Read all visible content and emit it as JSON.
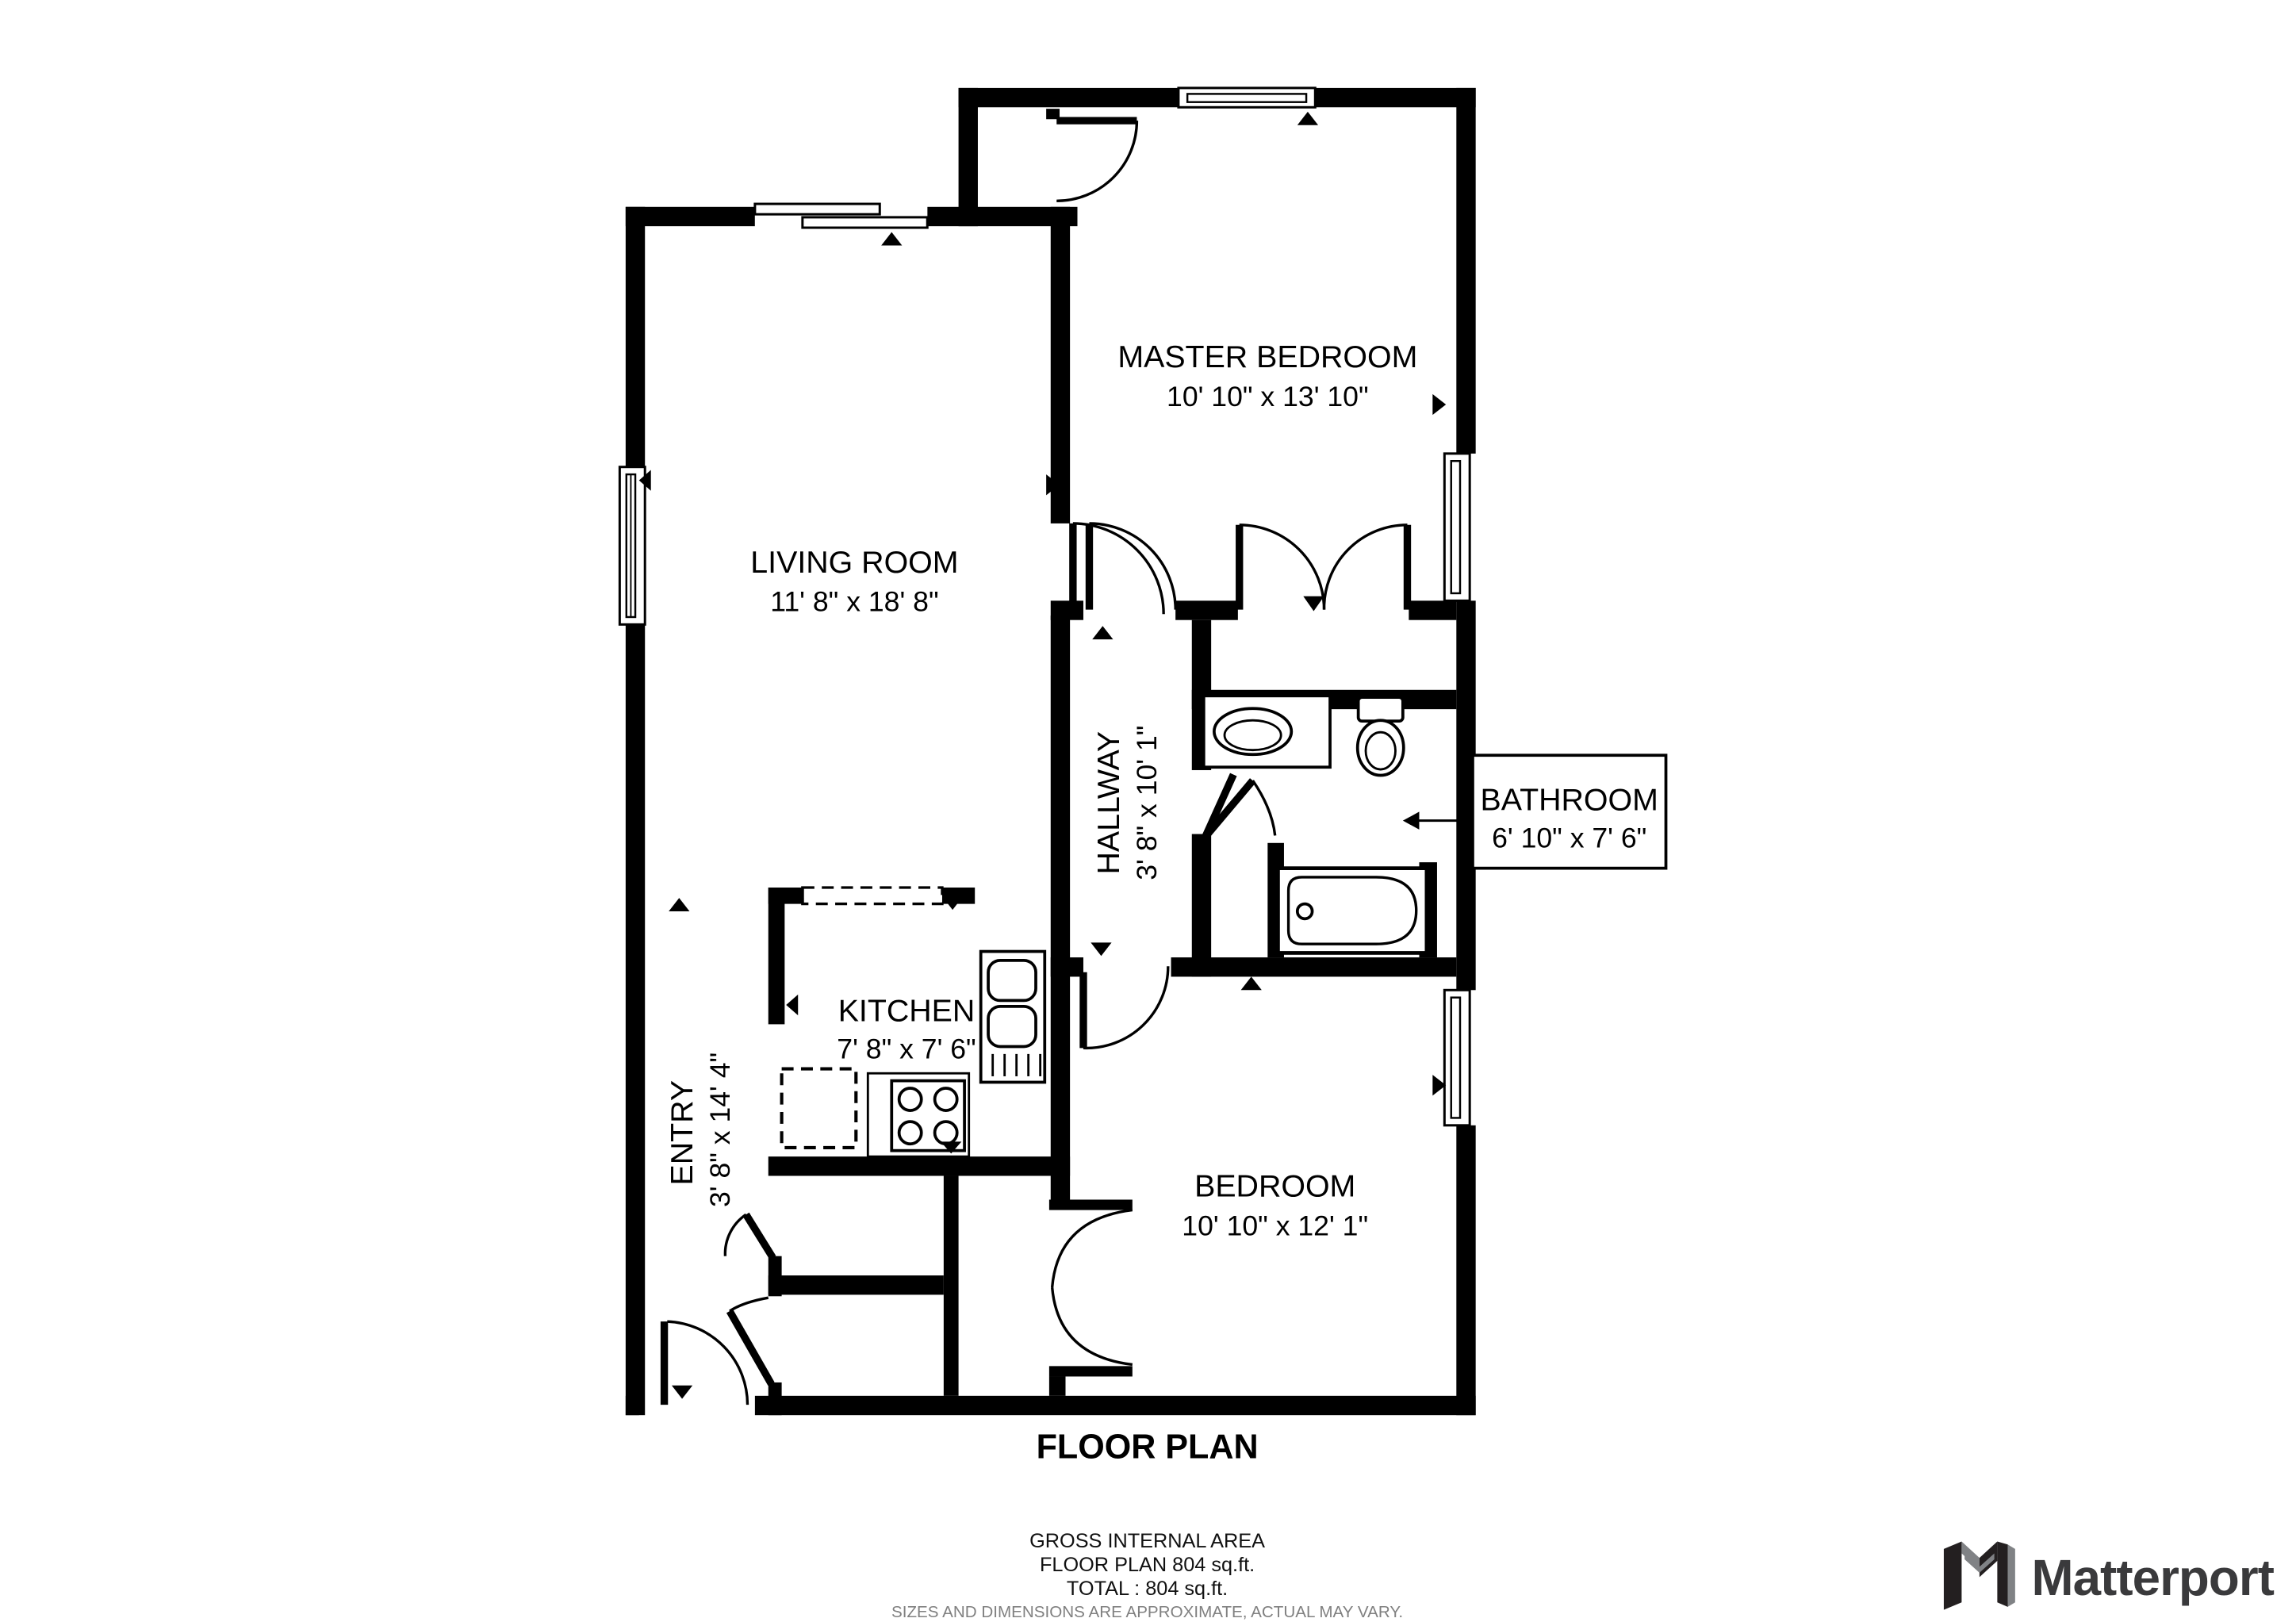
{
  "page": {
    "background": "#ffffff"
  },
  "floor_plan": {
    "title": "FLOOR PLAN",
    "rooms": {
      "master_bedroom": {
        "name": "MASTER BEDROOM",
        "dims": "10' 10\" x 13' 10\""
      },
      "living_room": {
        "name": "LIVING ROOM",
        "dims": "11' 8\" x 18' 8\""
      },
      "hallway": {
        "name": "HALLWAY",
        "dims": "3' 8\" x 10' 1\""
      },
      "bathroom": {
        "name": "BATHROOM",
        "dims": "6' 10\" x 7' 6\""
      },
      "kitchen": {
        "name": "KITCHEN",
        "dims": "7' 8\" x 7' 6\""
      },
      "entry": {
        "name": "ENTRY",
        "dims": "3' 8\" x 14' 4\""
      },
      "bedroom": {
        "name": "BEDROOM",
        "dims": "10' 10\" x 12' 1\""
      }
    },
    "area_summary": {
      "heading": "GROSS INTERNAL AREA",
      "floor_line": "FLOOR PLAN 804 sq.ft.",
      "total_line": "TOTAL :  804 sq.ft.",
      "disclaimer": "SIZES AND DIMENSIONS ARE APPROXIMATE, ACTUAL MAY VARY."
    },
    "branding": {
      "logo_text": "Matterport"
    },
    "colors": {
      "walls": "#000000",
      "background": "#ffffff",
      "disclaimer_text": "#808080",
      "logo_dark": "#3a3a3c",
      "logo_gray": "#808285"
    }
  }
}
